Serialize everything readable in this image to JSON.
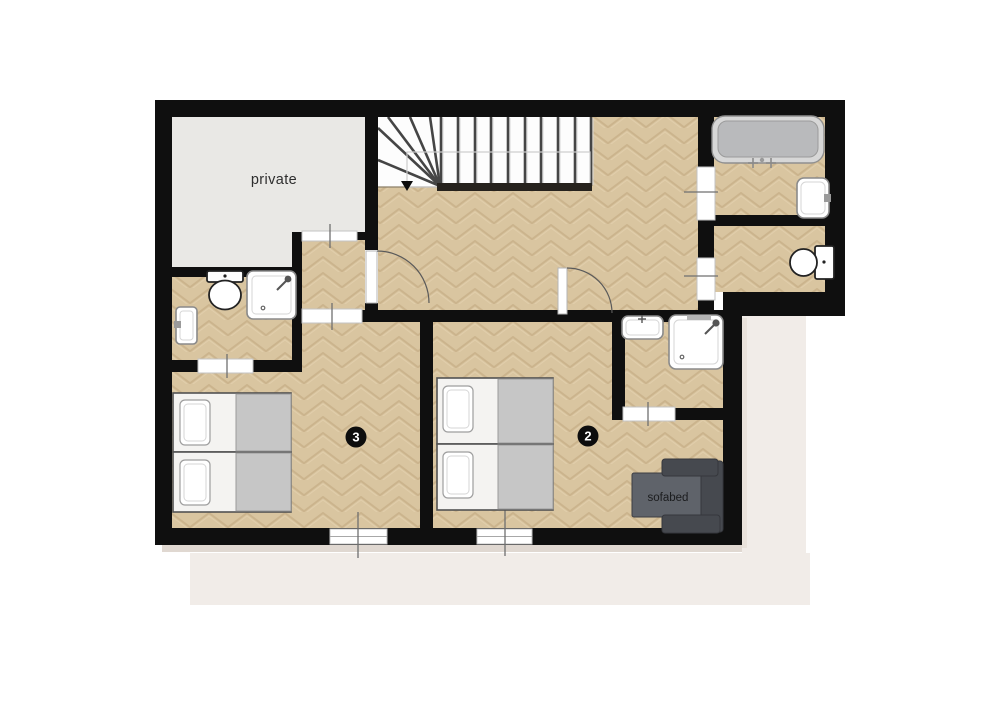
{
  "floorplan": {
    "title": "apartment upper floor plan",
    "rooms": [
      {
        "id": "private",
        "label": "private"
      },
      {
        "id": "bedroom-3",
        "badge": "3"
      },
      {
        "id": "bedroom-2",
        "badge": "2"
      },
      {
        "id": "sofabed-area",
        "label": "sofabed"
      }
    ],
    "stairs": {
      "direction_arrow": "▼"
    },
    "palette": {
      "wall": "#0f0f0f",
      "floor_base": "#d9c5a0",
      "private_floor": "#e9e8e5",
      "stair_bg": "#fdfdfd",
      "backdrop": "#f1ece8",
      "shadow": "#e0d8d1",
      "blanket": "#c6c6c6",
      "tub_outer": "#d7d7d7",
      "tub_inner": "#b9babc",
      "sofa_dark": "#46494f",
      "sofa_seat": "#5f636a",
      "fixture_stroke": "#8a8a8a",
      "door_line": "#5a5a5a",
      "tread": "#454545",
      "tick": "#6f6f6f",
      "badge_bg": "#0d0d0d",
      "label_color": "#2e2e2e"
    }
  }
}
